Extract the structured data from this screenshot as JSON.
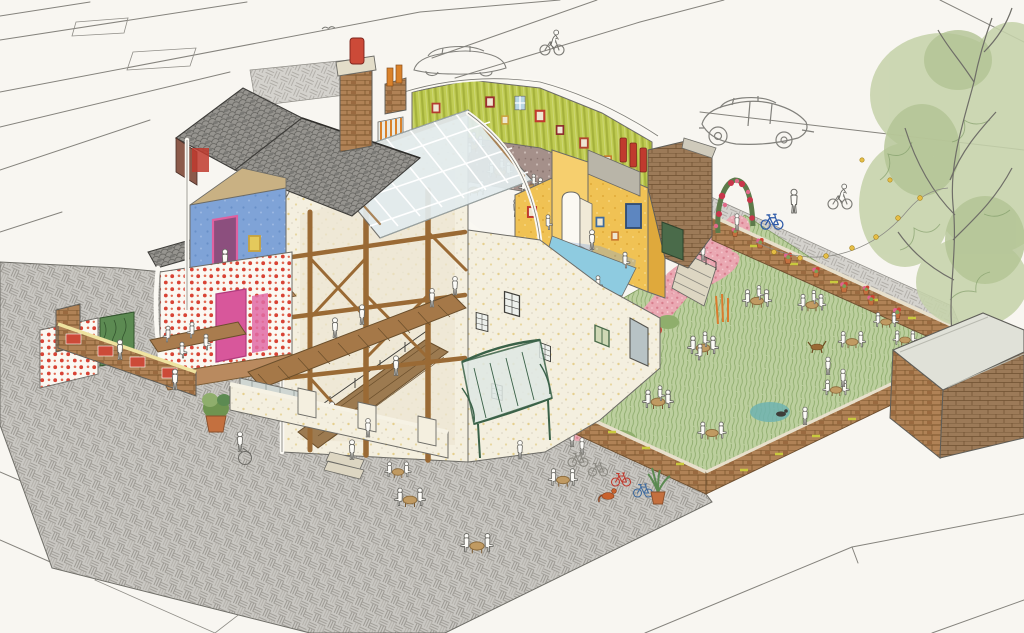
{
  "image": {
    "kind": "hand-drawn axonometric cutaway architectural illustration (colored pencil and ink on white paper)",
    "subject": "corner pub / cafe building opened up to show interiors, with walled beer garden, paved forecourt and surrounding streets",
    "visible_text": "none",
    "width_px": 1024,
    "height_px": 633
  },
  "palette": {
    "paper": "#f8f6f1",
    "pencil_line": "#85837d",
    "paving_grey": "#c9c7c2",
    "paving_hatch": "#a3a09a",
    "slate_roof": "#96948f",
    "slate_dark": "#5e5d59",
    "brick": "#b08256",
    "brick_joint": "#7c572f",
    "glazed_red_brick": "#cc4a38",
    "red_dot_wallpaper": "#d84335",
    "magenta_doorway": "#df61a0",
    "blue_room": "#7fa3d7",
    "lime_room": "#bfcb52",
    "mustard_room": "#f0c254",
    "pool_floor": "#8ecbe0",
    "glass_roof": "#e3ecee",
    "timber_frame": "#9a6a35",
    "cream_wall": "#f4efdf",
    "cream_speckle": "#e5cf8e",
    "grass": "#bccf9e",
    "grass_stroke": "#8aa968",
    "pink_path": "#eaa8b2",
    "mauve_floor": "#a5908a",
    "terracotta_pot": "#c4703f",
    "conservatory_green": "#3a6148",
    "tree_foliage": "#c6d3ab",
    "festoon_bulb": "#e5bd45",
    "attic_tan": "#c9b183"
  },
  "scene": {
    "streets": {
      "surface": "blank white paper with fine pencil kerb and setts lines",
      "corner_site": "grey basket-weave hatched pavement wraps the building on two sides",
      "upper_street": "hatched sidewalk strip behind the garden retaining wall"
    },
    "building": {
      "left_wing": [
        "dark slate pitched roofs",
        "tall brick chimney with red pot",
        "second small brick chimney with orange pots",
        "tan attic cut",
        "blue bedroom cutaway with magenta doorway and standing figure",
        "framed yellow picture",
        "red-spotted wallpaper room with magenta doorway",
        "long dining table with four diners",
        "green hedge panel",
        "brick planter walls with glazed red brick patches"
      ],
      "central_hall": [
        "cream speckled masonry",
        "exposed timber post-and-beam frame with braces",
        "internal stair with figures",
        "pitched glazed atrium roof with white glazing bars",
        "wavy white cut edges",
        "dark-mullion sash windows",
        "rear door and green-shuttered window"
      ],
      "green_attic_room": [
        "lime vertically-striped walls",
        "gallery of red, orange and gold picture frames",
        "two windows",
        "bunting flags",
        "orange striped curtain",
        "mauve speckled floor",
        "five cafe tables with diners",
        "figure dancing"
      ],
      "yellow_wing": [
        "mustard walls",
        "arched doorway with open leaf",
        "red and blue framed pictures",
        "blue framed window",
        "three red chimney pots",
        "stone corbel band",
        "pale blue floor terrace with three figures"
      ],
      "stone_gable": [
        "grey-brown brick wall with coping",
        "dark green door"
      ],
      "conservatory_porch": [
        "curved dark-green glazed canopy over rear entrance"
      ]
    },
    "garden": {
      "lawn": "scribbled colored-pencil grass",
      "path": "pink gravel S-path from rose arch down to garden gate",
      "rose_arch": "green arch covered in red and pink roses at top entrance",
      "stairs": "stone steps with dark railing from yellow wing terrace",
      "walls": "brick retaining walls with pale coping and yellow-green glazed accents",
      "wall_pots": 8,
      "tables_with_diners": 10,
      "flower_bed": [
        "pink spiky plants",
        "magenta blooms",
        "yellow ball flowers",
        "orange cat-tails",
        "teal shrub"
      ],
      "animals": [
        "brown dog on lawn",
        "dark cat by teal shrub"
      ],
      "figure_with_wheel": "lady pushing large-wheeled cycle on path",
      "festoon_lights": "string of yellow bulbs slung from the tree across the garden"
    },
    "forecourt": {
      "tables_with_diners": 4,
      "bicycles": [
        "two pencil-sketched bikes",
        "red bike",
        "blue bike leaning on garden wall"
      ],
      "potted_plants": [
        "aloe in terracotta pot",
        "shrub in terracotta pot by planter"
      ],
      "animal": "ginger cat",
      "low_cream_wall": "speckled wall with piers, glazed cold-frame and steps"
    },
    "street_life": {
      "cars": [
        "pencil-sketch car parked behind green room",
        "pencil-sketch car passing on upper road"
      ],
      "cyclists": 2,
      "pedestrians_walking": 4,
      "blue_bicycle_on_upper_street": 1,
      "bird_overhead": 1
    },
    "tree": "large tree at right edge, light green colored-pencil foliage over pencil trunk and branches",
    "outbuilding": "brick store at bottom right with pale concrete slab roof"
  },
  "counts": {
    "figures_total_approx": 70,
    "tables_total": 20,
    "picture_frames_approx": 12,
    "windows_approx": 12
  }
}
